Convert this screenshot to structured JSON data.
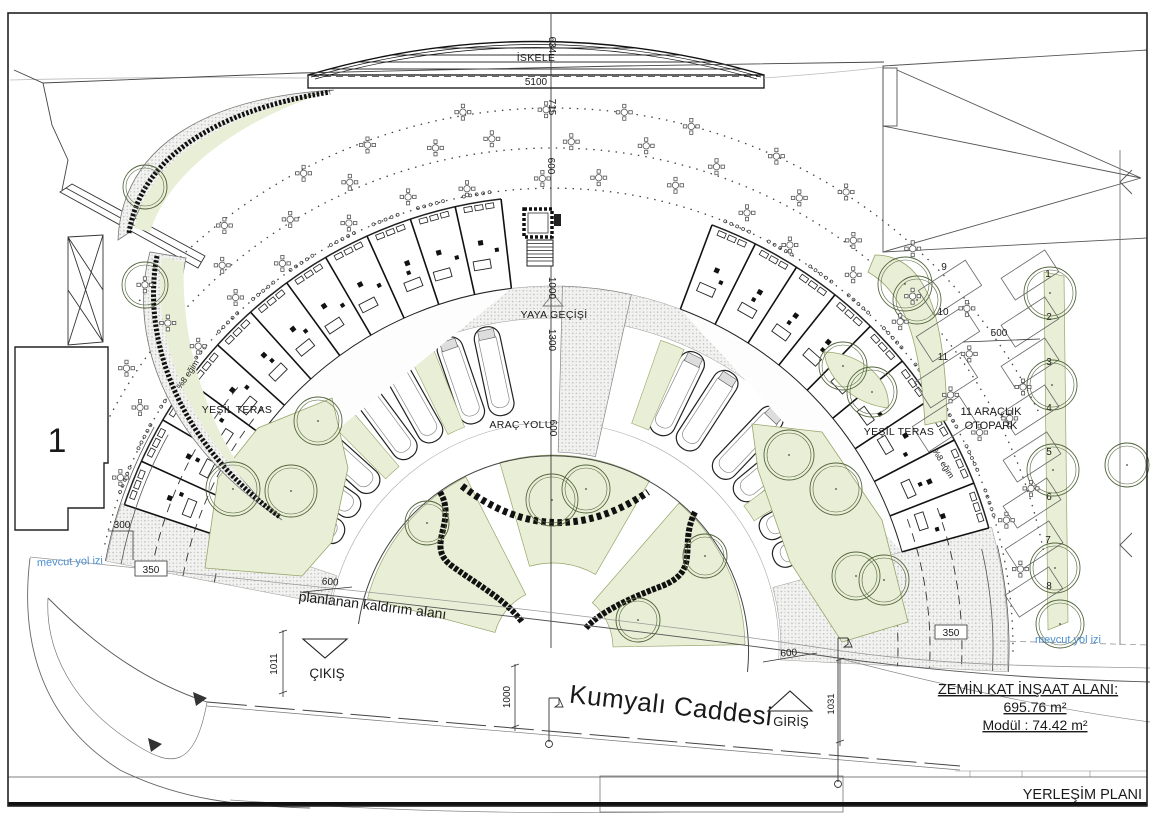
{
  "sheet": {
    "drawing_title": "YERLEŞİM PLANI"
  },
  "info_panel": {
    "heading": "ZEMİN KAT İNŞAAT ALANI:",
    "area_value": "695.76 m²",
    "module_value": "Modül : 74.42 m²"
  },
  "labels": {
    "pier": "İSKELE",
    "pedestrian_crossing": "YAYA GEÇİŞİ",
    "vehicle_road": "ARAÇ YOLU",
    "green_terrace_left": "YEŞİL TERAS",
    "green_terrace_right": "YEŞİL TERAS",
    "parking_area_line1": "11 ARAÇLIK",
    "parking_area_line2": "OTOPARK",
    "existing_road_left": "mevcut yol izi",
    "existing_road_right": "mevcut yol izi",
    "planned_sidewalk": "planlanan kaldırım alanı",
    "exit": "ÇIKIŞ",
    "entrance": "GİRİŞ",
    "street_name": "Kumyalı Caddesi",
    "building_number": "1",
    "slope_left": "%8 eğim",
    "slope_right": "%8 eğim"
  },
  "dimensions": {
    "pier_width": "5100",
    "pier_depth": "634",
    "pier_offset": "715",
    "terrace_depth": "600",
    "module_depth": "1000",
    "promenade_width": "1300",
    "road_width": "600",
    "left_setback": "300",
    "left_road": "350",
    "sidewalk_width": "600",
    "exit_width": "1011",
    "street_width": "1000",
    "entrance_width": "1031",
    "right_sidewalk": "600",
    "right_road": "350",
    "parking_aisle": "500"
  },
  "parking": {
    "numbers": [
      "1",
      "2",
      "3",
      "4",
      "5",
      "6",
      "7",
      "8",
      "9",
      "10",
      "11"
    ]
  },
  "colors": {
    "green_fill": "#e9efd6",
    "green_edge": "#97a46b",
    "line": "#1a1a1a",
    "blue_note": "#4d8fd1",
    "pavement_dot": "#bdbdbd"
  }
}
